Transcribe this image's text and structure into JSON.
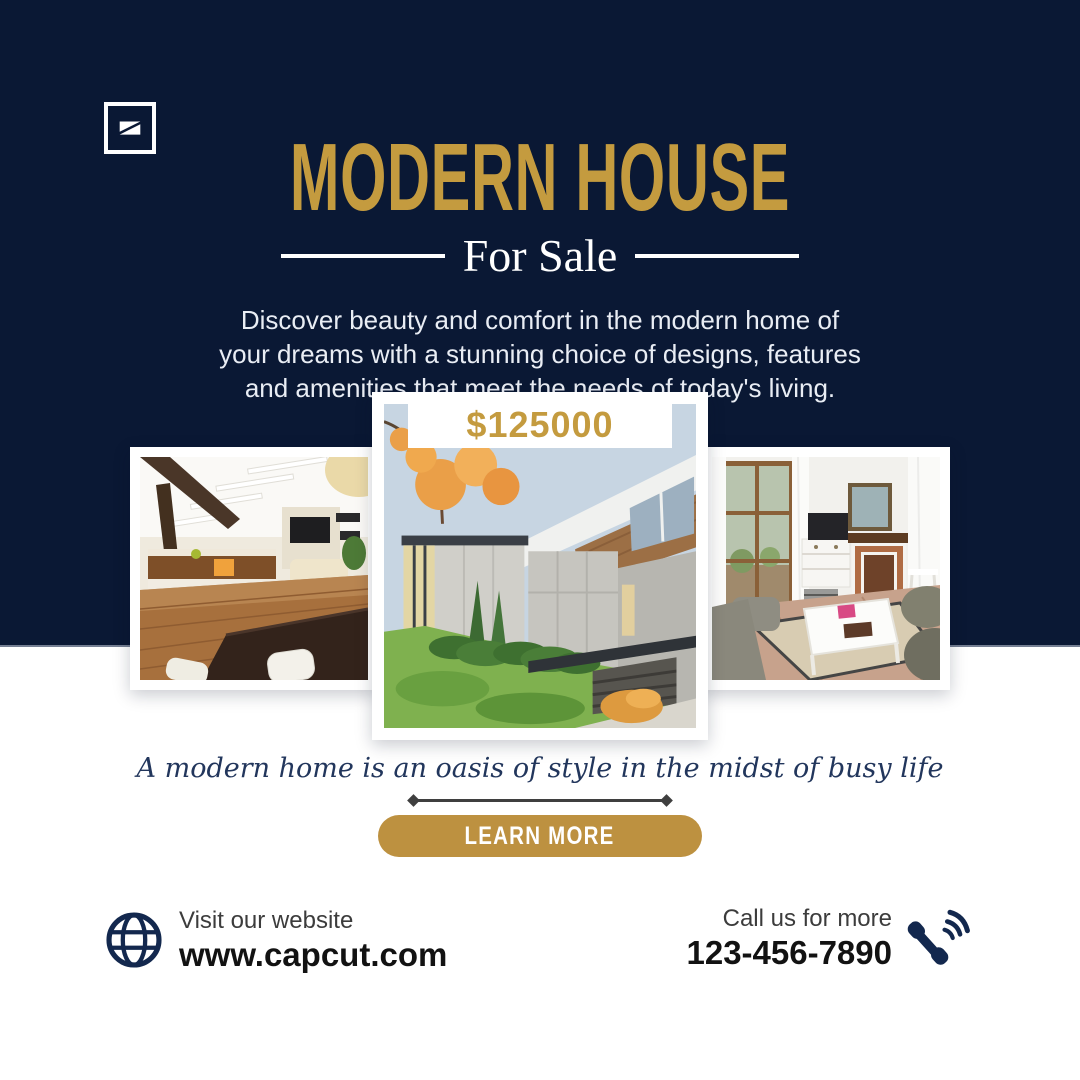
{
  "brand": {
    "logo_icon": "capcut-logo-icon"
  },
  "colors": {
    "navy": "#0a1834",
    "gold": "#c49b3f",
    "button_gold": "#bd9140",
    "white": "#ffffff",
    "quote_navy": "#22365c",
    "footer_label_gray": "#3c3c3c",
    "footer_value_dark": "#121212"
  },
  "header": {
    "title": "MODERN HOUSE",
    "subtitle": "For Sale",
    "description_lines": [
      "Discover beauty and comfort in the modern home of",
      "your dreams with a stunning choice of designs, features",
      "and amenities that meet the needs of today's living."
    ]
  },
  "listing": {
    "price": "$125000",
    "photos": [
      "interior-living-dining",
      "modern-house-exterior",
      "living-room-fireplace"
    ]
  },
  "quote": {
    "text": "A modern home is an oasis of style in the midst of busy life"
  },
  "cta": {
    "label": "LEARN MORE"
  },
  "footer": {
    "website": {
      "icon": "globe-icon",
      "label": "Visit our website",
      "value": "www.capcut.com"
    },
    "phone": {
      "icon": "phone-icon",
      "label": "Call us for more",
      "value": "123-456-7890"
    }
  }
}
